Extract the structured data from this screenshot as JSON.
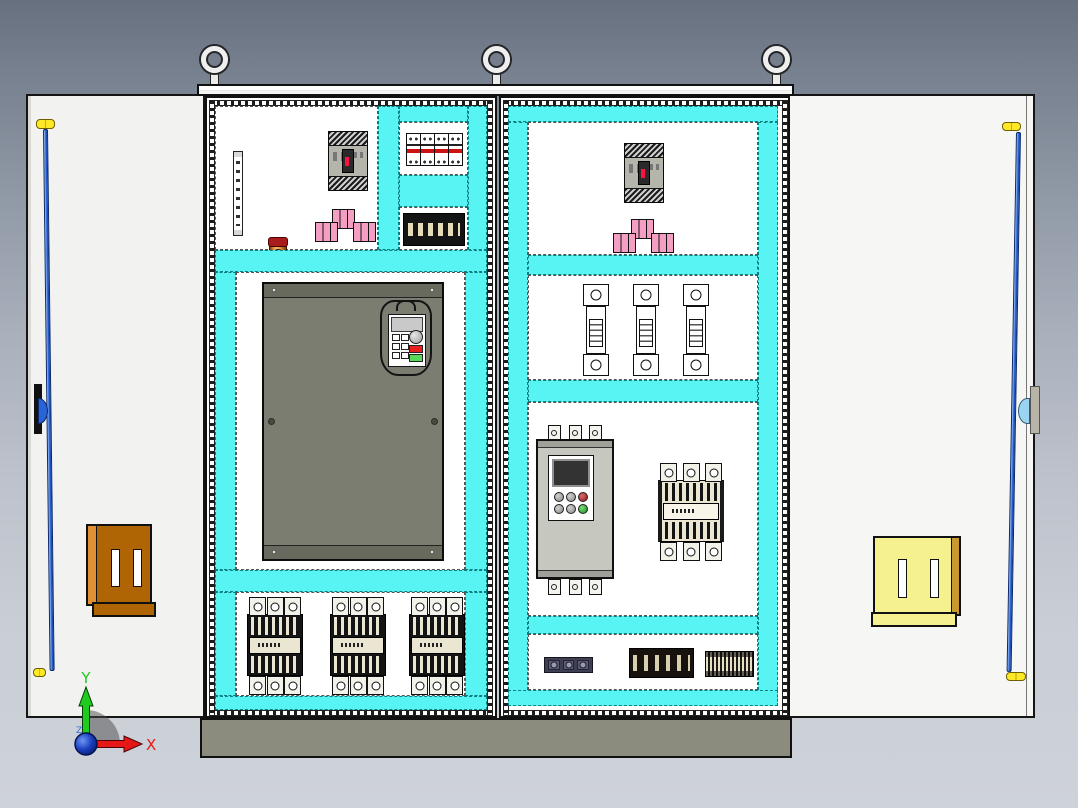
{
  "triad": {
    "x": "X",
    "y": "Y",
    "z": "Z"
  },
  "palette": {
    "background_top": "#66707f",
    "background_bottom": "#ced2d9",
    "duct_cyan": "#58f4f4",
    "panel_white": "#ffffff",
    "plinth_gray": "#8c8c7e",
    "door_white": "#f2f2f0",
    "pocket_brown": "#b06504",
    "pocket_yellow": "#f5f18e",
    "rod_blue": "#2a62d8",
    "busbar_copper": "#e89a4a",
    "wire_label_pink": "#f59ec4",
    "vfd_gray": "#7b7d70",
    "soft_starter_gray": "#c6c8c0",
    "axis_x_red": "#e61717",
    "axis_y_green": "#1ecb1e",
    "axis_z_blue": "#2b6be0"
  },
  "counts": {
    "lifting_eyes": 3,
    "cabinets": 2,
    "doors": 2,
    "contactors_left": 3,
    "fuses_right": 3
  },
  "components": {
    "left_cabinet": [
      "terminal-strip",
      "copper-busbar",
      "molded-case-breaker",
      "pink-wire-labels",
      "mini-breaker-row",
      "terminal-block-strip",
      "variable-frequency-drive",
      "contactor",
      "contactor",
      "contactor"
    ],
    "right_cabinet": [
      "molded-case-breaker",
      "pink-wire-labels",
      "fuse-holder",
      "fuse-holder",
      "fuse-holder",
      "soft-starter",
      "contactor",
      "relay-terminal-row",
      "terminal-block-strip",
      "din-terminal-row"
    ],
    "left_door": [
      "door-locking-rod",
      "document-pocket"
    ],
    "right_door": [
      "door-locking-rod",
      "document-pocket"
    ]
  }
}
